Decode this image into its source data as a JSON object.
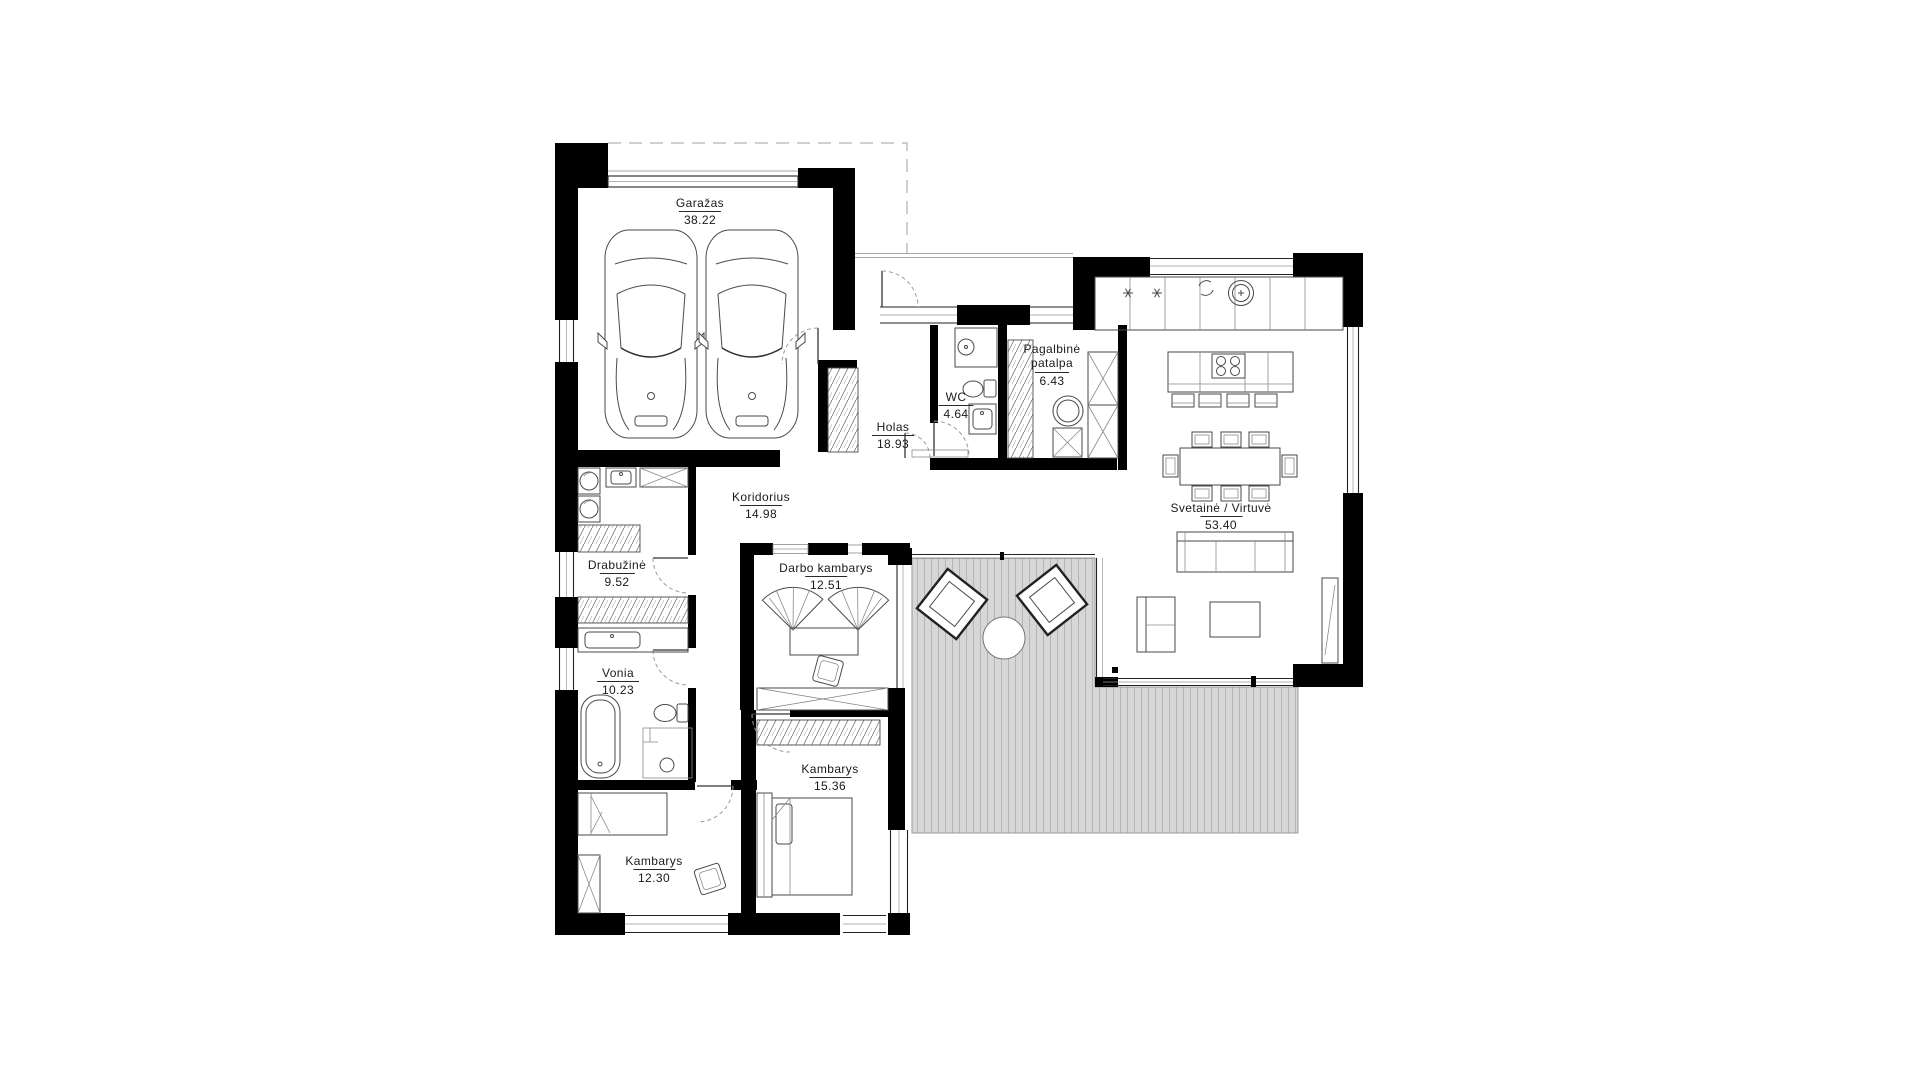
{
  "document": {
    "kind": "architectural floor plan"
  },
  "rooms": [
    {
      "name": "Garažas",
      "area": "38.22"
    },
    {
      "name": "Holas",
      "area": "18.93"
    },
    {
      "name": "WC",
      "area": "4.64"
    },
    {
      "name": "Pagalbinė patalpa",
      "area": "6.43"
    },
    {
      "name": "Svetainė / Virtuvė",
      "area": "53.40"
    },
    {
      "name": "Koridorius",
      "area": "14.98"
    },
    {
      "name": "Drabužinė",
      "area": "9.52"
    },
    {
      "name": "Darbo kambarys",
      "area": "12.51"
    },
    {
      "name": "Vonia",
      "area": "10.23"
    },
    {
      "name": "Kambarys",
      "area": "15.36"
    },
    {
      "name": "Kambarys",
      "area": "12.30"
    }
  ],
  "colors": {
    "wall": "#000000",
    "furniture_line": "#4a4a4a",
    "terrace_fill": "#d7d7d7",
    "terrace_stripe": "#b5b5b5",
    "text": "#1a1a1a",
    "background": "#ffffff"
  }
}
